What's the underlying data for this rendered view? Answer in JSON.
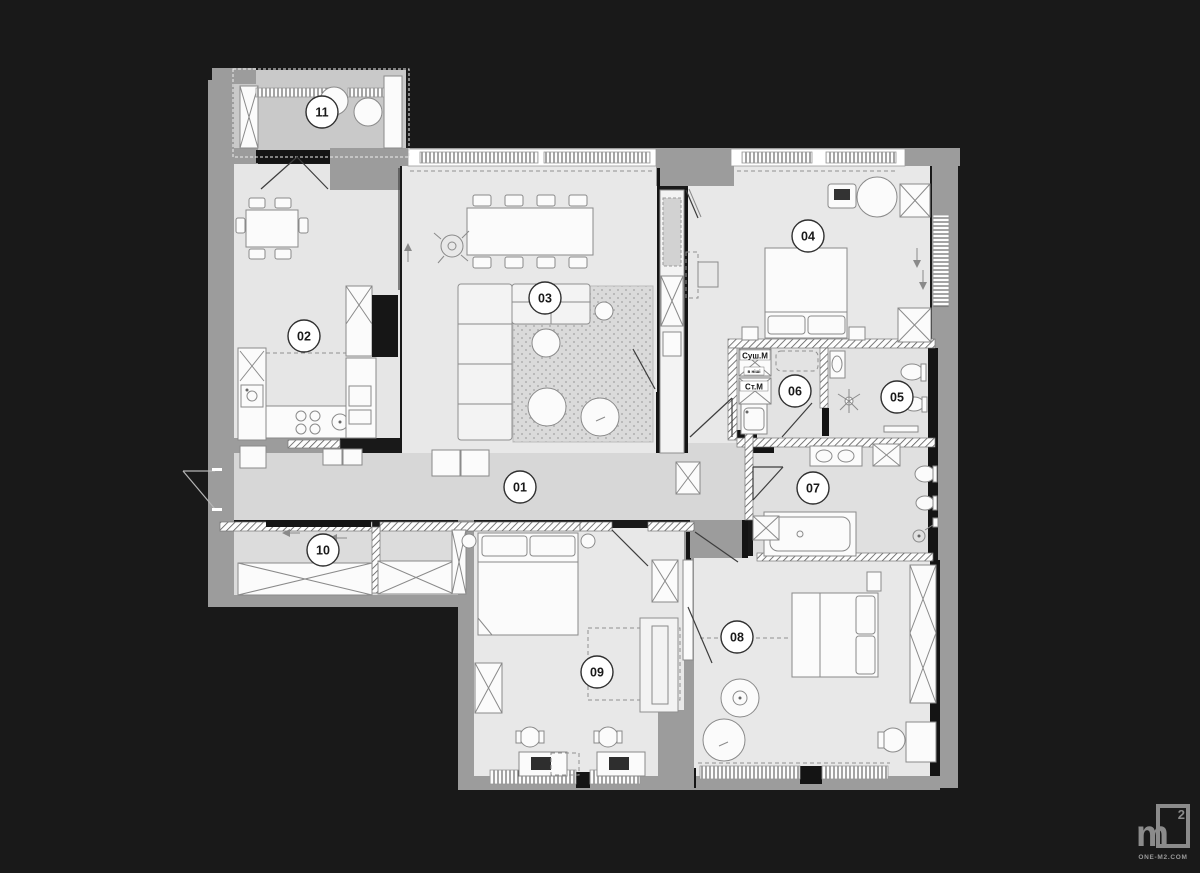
{
  "floorplan": {
    "rooms": [
      {
        "number": "01"
      },
      {
        "number": "02"
      },
      {
        "number": "03"
      },
      {
        "number": "04"
      },
      {
        "number": "05"
      },
      {
        "number": "06"
      },
      {
        "number": "07"
      },
      {
        "number": "08"
      },
      {
        "number": "09"
      },
      {
        "number": "10"
      },
      {
        "number": "11"
      }
    ],
    "laundry_labels": {
      "dryer": "Суш.М",
      "dryer_note": "в ніші",
      "washer": "Ст.М"
    }
  },
  "branding": {
    "logo_letter": "m",
    "logo_superscript": "2",
    "website": "ONE-M2.COM"
  },
  "colors": {
    "background": "#191919",
    "floor_light": "#e7e7e7",
    "floor_corridor": "#d7d7d7",
    "floor_balcony": "#c9c9c9",
    "wall_gray": "#9c9c9c",
    "wall_dark": "#141414",
    "furniture_fill": "#fbfbfb",
    "line": "#8a8a8a"
  }
}
